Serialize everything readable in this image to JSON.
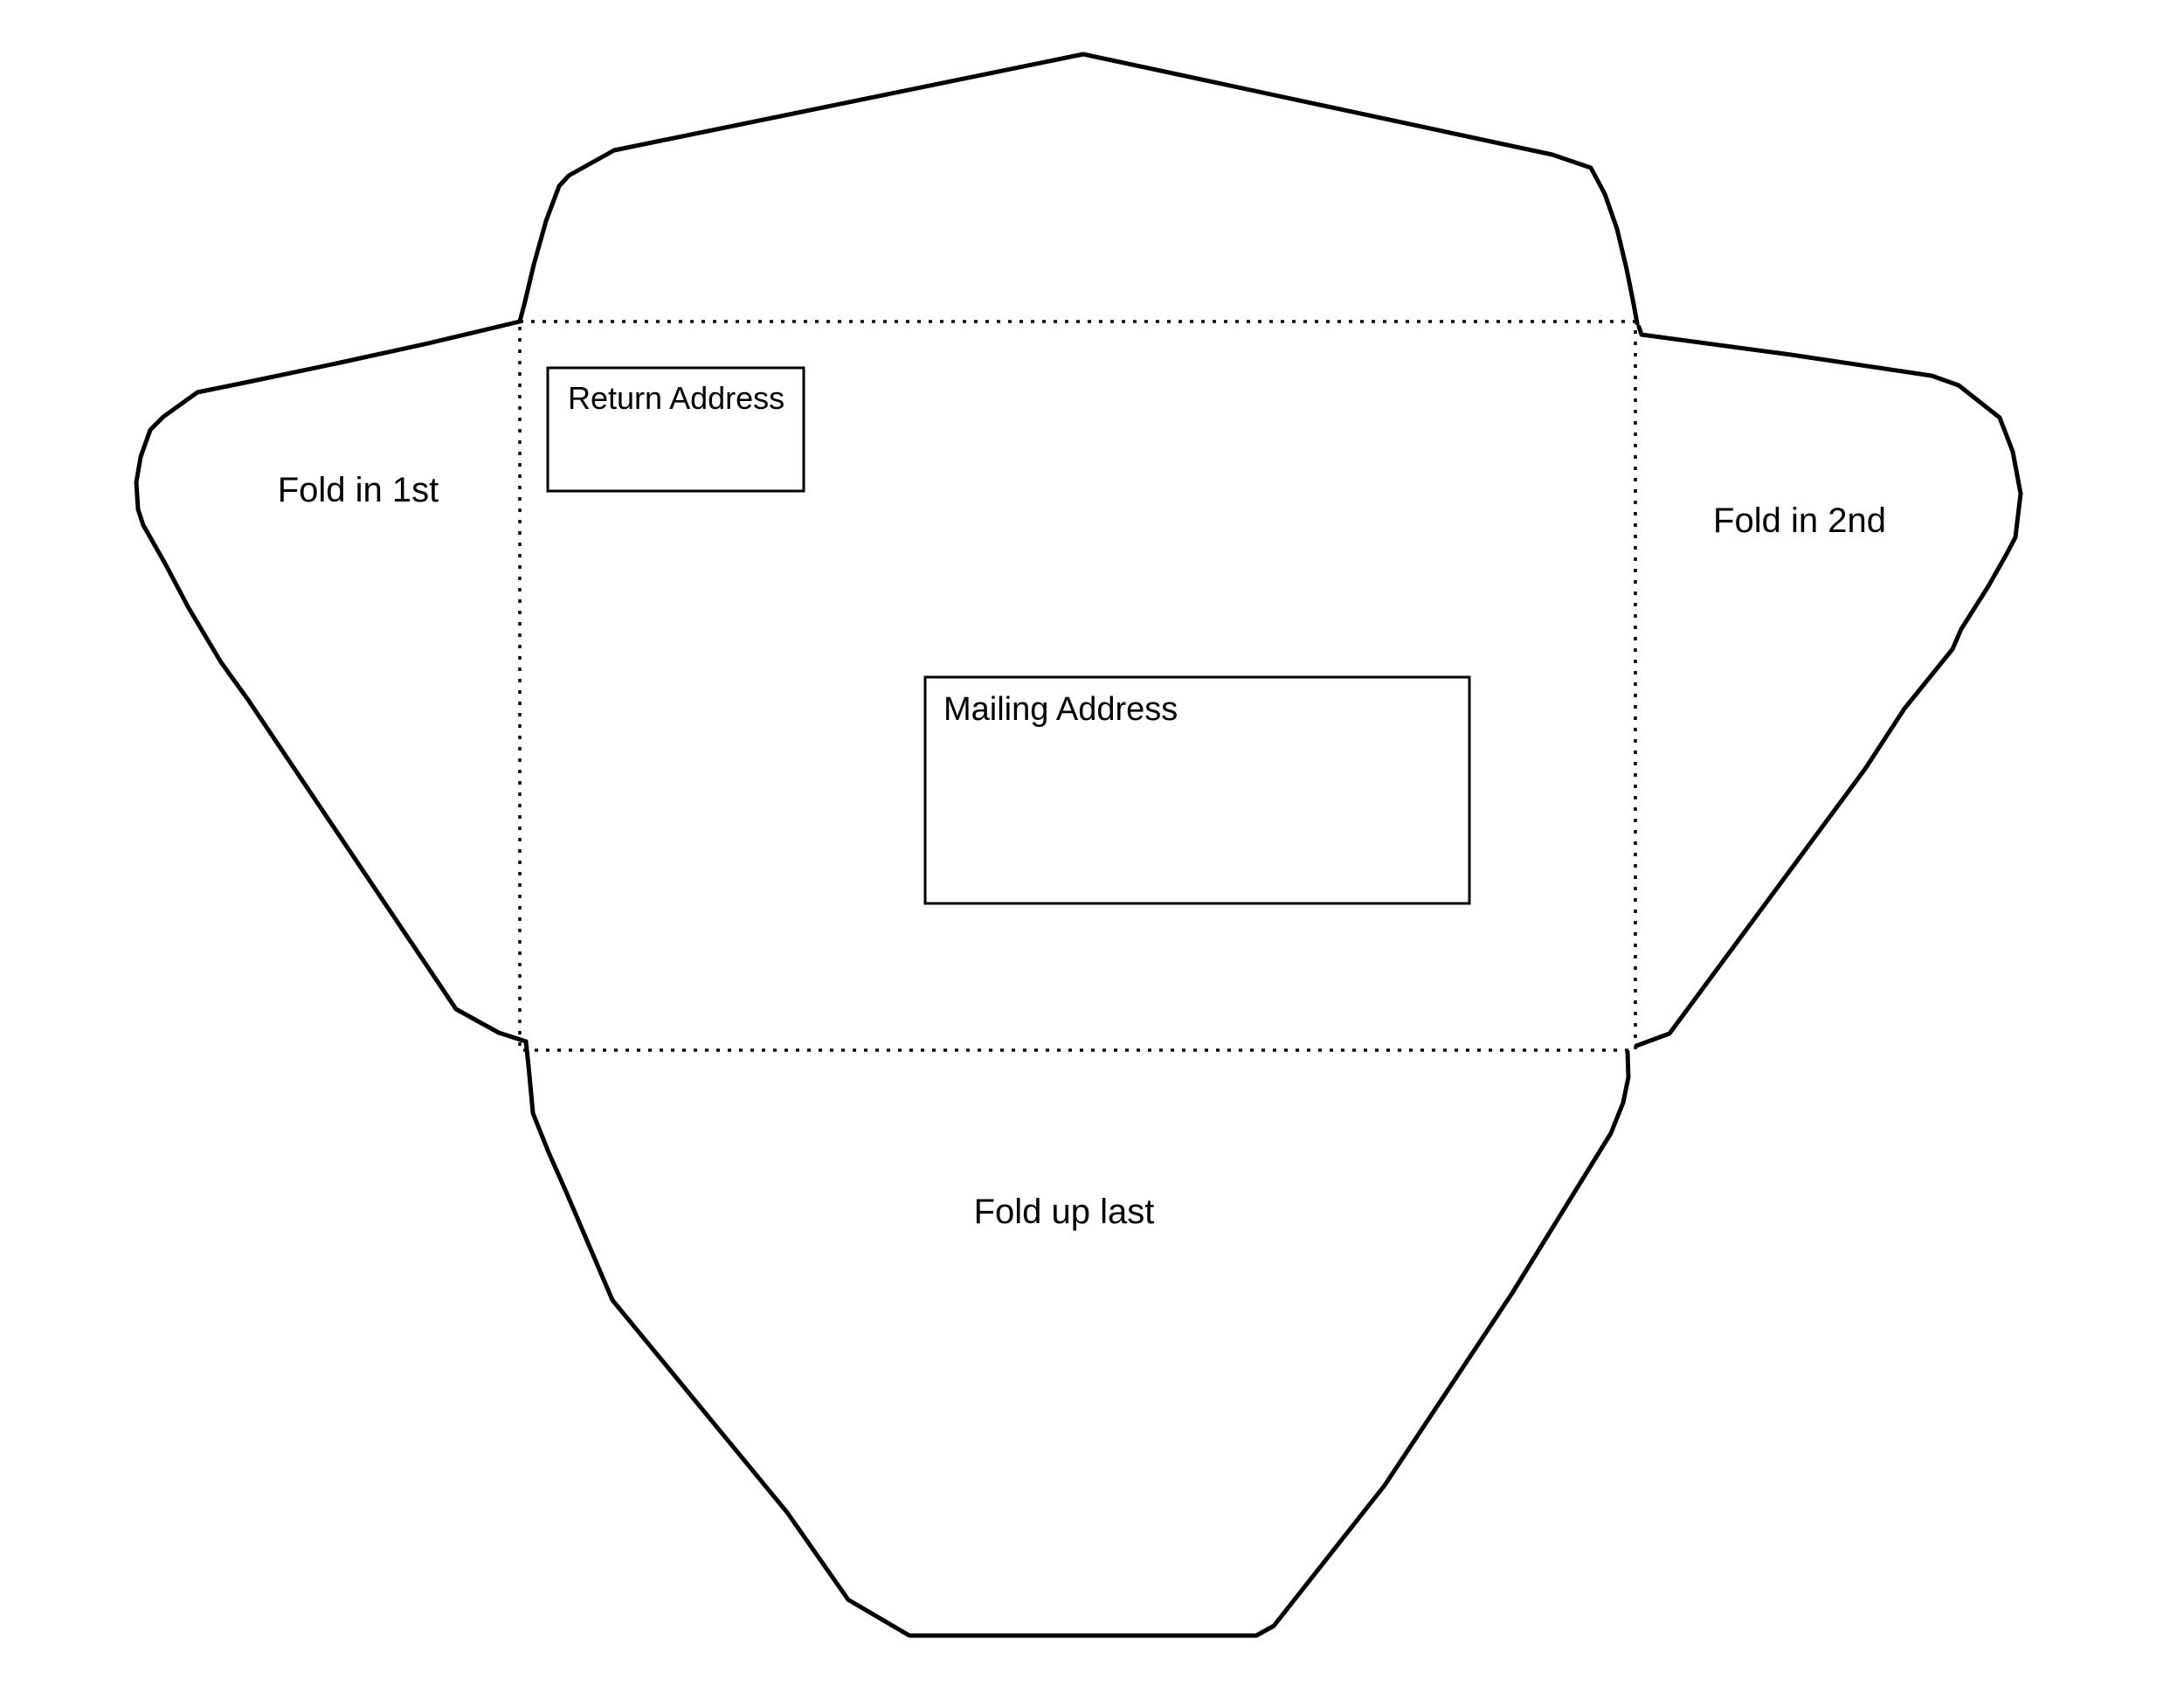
{
  "envelope_template": {
    "colors": {
      "background": "#ffffff",
      "line": "#000000",
      "text": "#000000"
    },
    "return_address": {
      "label": "Return Address"
    },
    "mailing_address": {
      "label": "Mailing Address"
    },
    "flap_labels": {
      "left": "Fold in 1st",
      "right": "Fold in 2nd",
      "bottom": "Fold up last"
    }
  }
}
